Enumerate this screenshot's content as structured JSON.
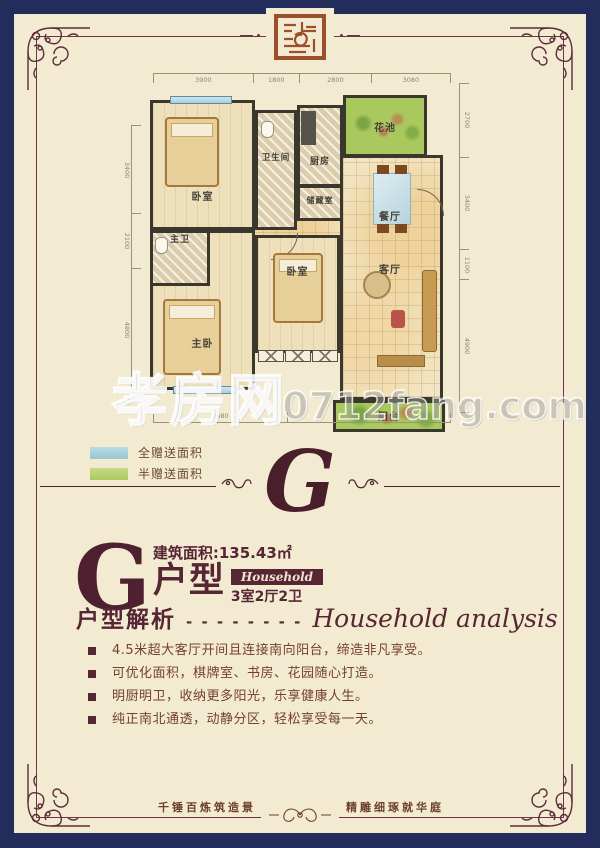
{
  "colors": {
    "navy": "#232d5c",
    "cream": "#f3ebd1",
    "maroon": "#572634",
    "rust": "#9d4f2c",
    "legend_blue": "#a7d0da",
    "legend_green": "#b5d06e",
    "plan_green": "#a9c95e"
  },
  "floorplan": {
    "rooms": [
      {
        "key": "bedroom-top",
        "label": "卧室"
      },
      {
        "key": "bathroom",
        "label": "卫生间"
      },
      {
        "key": "kitchen",
        "label": "厨房"
      },
      {
        "key": "flower-pond",
        "label": "花池"
      },
      {
        "key": "storage",
        "label": "储藏室"
      },
      {
        "key": "dining",
        "label": "餐厅"
      },
      {
        "key": "master-bath",
        "label": "主卫"
      },
      {
        "key": "master-bedroom",
        "label": "主卧"
      },
      {
        "key": "bedroom-mid",
        "label": "卧室"
      },
      {
        "key": "living",
        "label": "客厅"
      },
      {
        "key": "balcony",
        "label": "阳台"
      }
    ],
    "dims": {
      "top": [
        "3900",
        "1800",
        "2800",
        "3080"
      ],
      "right": [
        "2700",
        "3400",
        "1100",
        "4900"
      ],
      "left": [
        "3400",
        "2100",
        "4800"
      ],
      "bottom": [
        "3680",
        "4500"
      ]
    }
  },
  "watermark": {
    "site_name": "孝房网",
    "site_url": "0712fang.com"
  },
  "legend": {
    "items": [
      {
        "label": "全赠送面积",
        "color": "#a7d0da"
      },
      {
        "label": "半赠送面积",
        "color": "#b5d06e"
      }
    ]
  },
  "divider": {
    "letter": "G"
  },
  "unit": {
    "letter": "G",
    "area": "建筑面积:135.43㎡",
    "type_suffix": "户型",
    "badge": "Household",
    "rooms_summary": "3室2厅2卫"
  },
  "analysis": {
    "title": "户型解析",
    "dashes": "- - - - - - - -",
    "subtitle": "Household analysis",
    "bullets": [
      "4.5米超大客厅开间且连接南向阳台，缔造非凡享受。",
      "可优化面积，棋牌室、书房、花园随心打造。",
      "明厨明卫，收纳更多阳光，乐享健康人生。",
      "纯正南北通透，动静分区，轻松享受每一天。"
    ]
  },
  "footer": {
    "left": "千锤百炼筑造景",
    "right": "精雕细琢就华庭"
  }
}
